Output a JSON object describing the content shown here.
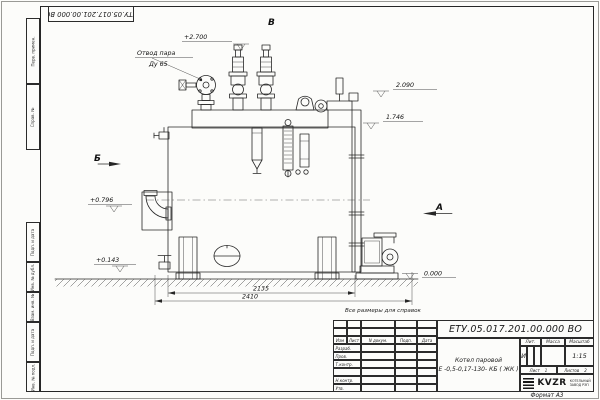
{
  "page": {
    "format_note": "Формат А3",
    "reference_note": "Все размеры для справок"
  },
  "corner_stamp": {
    "doc_number": "ЕТУ.05.017.201.00.000 ВО"
  },
  "margin_labels": {
    "top": [
      "Перв. примен.",
      "Справ. №"
    ],
    "bottom": [
      "Подп. и дата",
      "Инв. № дубл.",
      "Взам. инв. №",
      "Подп. и дата",
      "Инв. № подл."
    ]
  },
  "drawing": {
    "labels": {
      "steam_line1": "Отвод пара",
      "steam_line2": "Ду 65",
      "view_a": "А",
      "view_b": "Б",
      "view_v": "В"
    },
    "elevations": {
      "e2700": "+2.700",
      "e2090": "2.090",
      "e1746": "1.746",
      "e0796": "+0.796",
      "e0143": "+0.143",
      "e0000": "0.000"
    },
    "dimensions": {
      "inner": "2135",
      "outer": "2410"
    }
  },
  "title_block": {
    "doc_number": "ЕТУ.05.017.201.00.000  ВО",
    "product_line1": "Котел паровой",
    "product_line2": "Е -0,5-0,17-130- КБ ( ЖК )",
    "col_headers": [
      "Изм",
      "Лист",
      "N докум.",
      "Подп.",
      "Дата"
    ],
    "row_labels": [
      "Разраб.",
      "Пров.",
      "Т.контр.",
      "",
      "Н.контр.",
      "Утв."
    ],
    "lit_header": "Лит.",
    "mass_header": "Масса",
    "scale_header": "Масштаб",
    "lit_value": "И",
    "scale_value": "1:15",
    "sheet_label": "Лист",
    "sheet_value": "1",
    "sheets_label": "Листов",
    "sheets_value": "2",
    "logo_text": "KVZR",
    "logo_sub1": "КОТЕЛЬНЫЙ",
    "logo_sub2": "ЗАВОД РЭП"
  }
}
